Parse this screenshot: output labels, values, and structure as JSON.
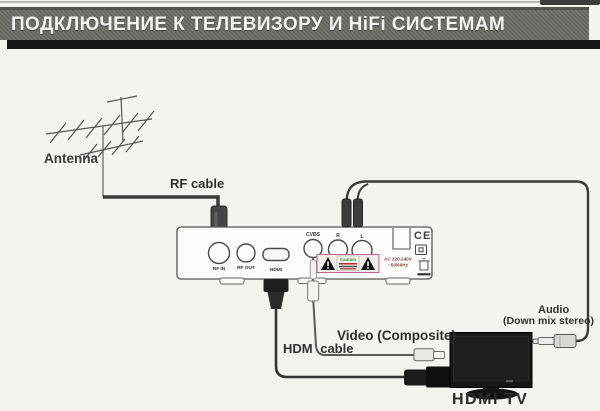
{
  "header": {
    "title": "ПОДКЛЮЧЕНИЕ К ТЕЛЕВИЗОРУ И HiFi СИСТЕМАМ"
  },
  "labels": {
    "antenna": "Antenna",
    "rf_cable": "RF cable",
    "hdmi_cable": "HDM cable",
    "video": "Video (Composite)",
    "audio": "Audio",
    "audio_sub": "(Down mix stereo)",
    "tv": "HDMI TV"
  },
  "device": {
    "ports": {
      "rf_in": "RF IN",
      "rf_out": "RF OUT",
      "hdmi": "HDMI",
      "cvbs": "CVBS",
      "audio_r": "R",
      "audio_l": "L"
    },
    "markings": {
      "ce": "CE",
      "caution": "Caution",
      "power_line1": "AC 220-240V",
      "power_line2": "~50/60Hz"
    }
  },
  "colors": {
    "page_bg": "#f4f3ef",
    "header_bar": "#6a6e65",
    "header_text": "#f4f4f2",
    "header_shadow": "#161616",
    "line_art": "#4a4a4a",
    "cable_dark": "#3a3a3a",
    "caution_border": "#c45f93",
    "caution_text": "#2e8b2e",
    "power_text": "#8a4040",
    "tv_black": "#161616"
  }
}
